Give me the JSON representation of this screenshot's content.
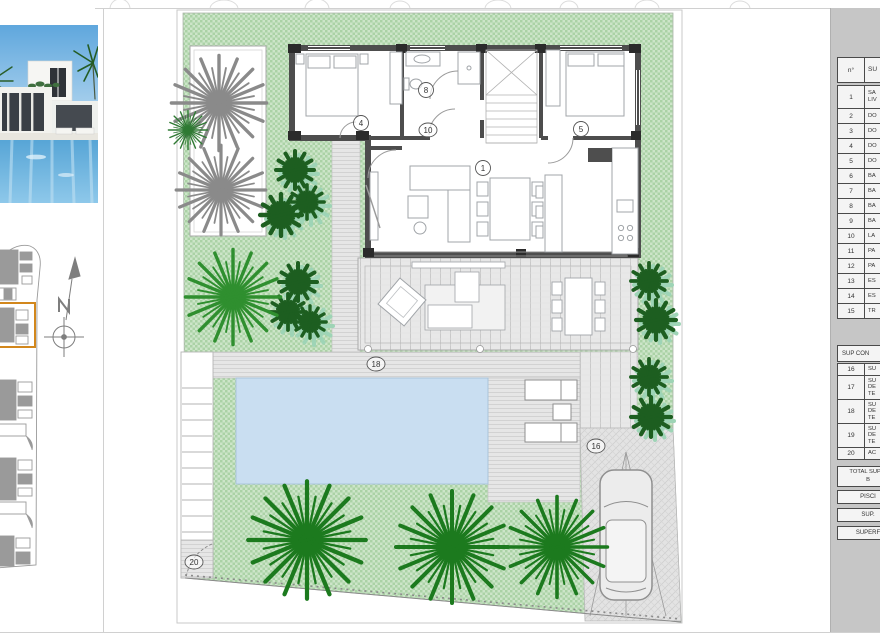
{
  "sheet": {
    "type": "villa site plan drawing"
  },
  "colors": {
    "grass": "#cde5c9",
    "grass_dark": "#abd2a6",
    "pool": "#c9def1",
    "wall": "#4d4d4d",
    "accent_orange": "#d2871c",
    "panel_gray": "#c6c6c6",
    "plant_dark_green": "#1d5e20",
    "plant_palm_green": "#1c7a1e",
    "plant_gray": "#8a8a8a"
  },
  "plan": {
    "labels": {
      "living": "1",
      "bed_left": "4",
      "bed_right": "5",
      "bath": "8",
      "hall": "10",
      "parking": "16",
      "terrace": "18",
      "entrance": "20"
    }
  },
  "table": {
    "header": {
      "num": "n°",
      "label": "SU"
    },
    "rows": [
      {
        "n": "1",
        "label": "SA\nLIV"
      },
      {
        "n": "2",
        "label": "DO"
      },
      {
        "n": "3",
        "label": "DO"
      },
      {
        "n": "4",
        "label": "DO"
      },
      {
        "n": "5",
        "label": "DO"
      },
      {
        "n": "6",
        "label": "BA"
      },
      {
        "n": "7",
        "label": "BA"
      },
      {
        "n": "8",
        "label": "BA"
      },
      {
        "n": "9",
        "label": "BA"
      },
      {
        "n": "10",
        "label": "LA"
      },
      {
        "n": "11",
        "label": "PA"
      },
      {
        "n": "12",
        "label": "PA"
      },
      {
        "n": "13",
        "label": "ES"
      },
      {
        "n": "14",
        "label": "ES"
      },
      {
        "n": "15",
        "label": "TR"
      }
    ],
    "section_header": "SUP CON",
    "rows2": [
      {
        "n": "16",
        "label": "SU"
      },
      {
        "n": "17",
        "label": "SU\nDE\nTE"
      },
      {
        "n": "18",
        "label": "SU\nDE\nTE"
      },
      {
        "n": "19",
        "label": "SU\nDE\nTE"
      },
      {
        "n": "20",
        "label": "AC"
      }
    ],
    "total": "TOTAL SUP C\nB",
    "bands": [
      "PISCI",
      "SUP.",
      "SUPERF"
    ]
  }
}
